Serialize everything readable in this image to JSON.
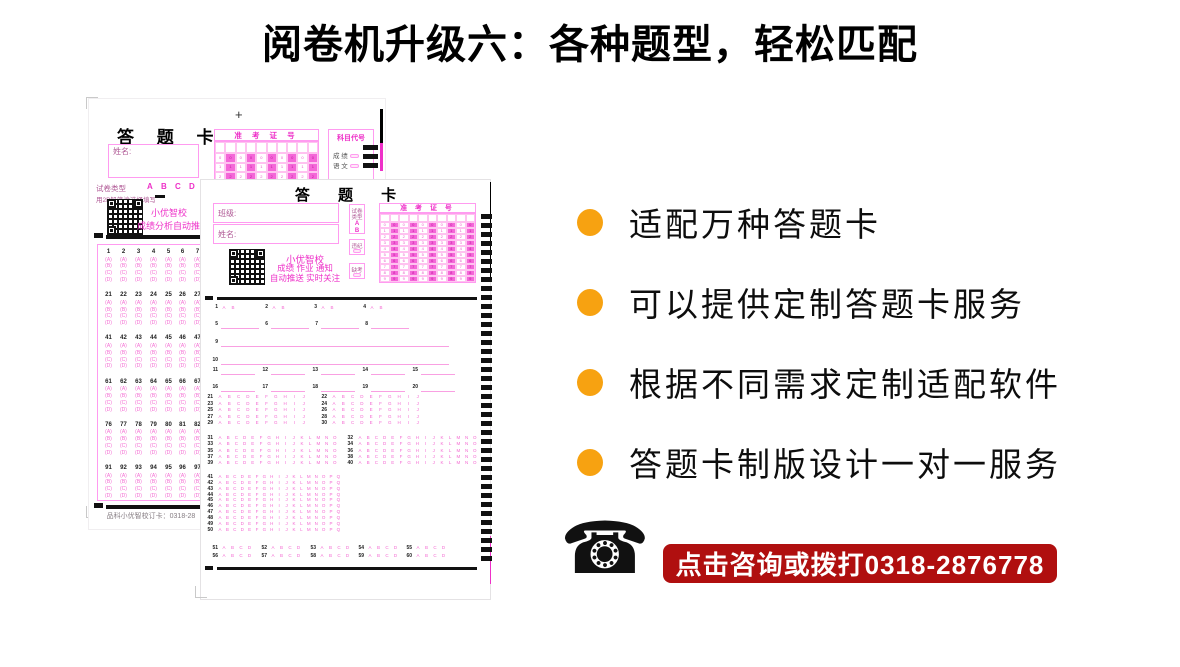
{
  "title": "阅卷机升级六：各种题型，轻松匹配",
  "colors": {
    "accent_orange": "#F7A211",
    "banner_red": "#B00F0F",
    "magenta_strong": "#EE30C8",
    "magenta_letter": "#F46AD2",
    "pink_border": "#FF9BF0",
    "pink_line": "#F9A0E2",
    "label_magenta": "#B05A96"
  },
  "bullets": [
    {
      "label": "适配万种答题卡"
    },
    {
      "label": "可以提供定制答题卡服务"
    },
    {
      "label": "根据不同需求定制适配软件"
    },
    {
      "label": "答题卡制版设计一对一服务"
    }
  ],
  "contact": {
    "phone_icon_glyph": "☎",
    "banner_text": "点击咨询或拨打0318-2876778"
  },
  "sheet_back": {
    "title": "答 题 卡",
    "plus_mark": "+",
    "name_label": "姓名:",
    "ticket_header": "准 考 证 号",
    "subject_code_header": "科目代号",
    "subject_rows": [
      "成 绩",
      "语 文"
    ],
    "paper_type_label": "试卷类型",
    "paper_type_options": [
      "A",
      "B",
      "C",
      "D"
    ],
    "pencil_note": "用2B铅笔涂选择填写",
    "qr_caption_lines": [
      "小优智校",
      "成绩分析自动推送"
    ],
    "answer_blocks": [
      {
        "start": 1
      },
      {
        "start": 21
      },
      {
        "start": 41
      },
      {
        "start": 61
      },
      {
        "start": 76
      },
      {
        "start": 91
      }
    ],
    "choices": [
      "A",
      "B",
      "C",
      "D"
    ],
    "footer": "品科小优智校订卡：0318-28"
  },
  "sheet_front": {
    "title": "答 题 卡",
    "class_label": "班级:",
    "name_label": "姓名:",
    "paper_type_label_lines": [
      "试卷",
      "类型"
    ],
    "paper_type_options": [
      "A",
      "B"
    ],
    "violation_label": "违纪",
    "absent_label": "缺考",
    "ticket_header": "准 考 证 号",
    "qr_caption_lines": [
      "小优智校",
      "成绩 作业 通知",
      "自动推送 实时关注"
    ],
    "questions": {
      "true_false": {
        "numbers": [
          1,
          2,
          3,
          4
        ],
        "options": [
          "A",
          "B"
        ]
      },
      "fill_short": [
        5,
        6,
        7,
        8
      ],
      "fill_long": [
        9,
        10
      ],
      "fill_rows": [
        [
          11,
          12,
          13,
          14,
          15
        ],
        [
          16,
          17,
          18,
          19,
          20
        ]
      ],
      "multi_10": {
        "left": [
          21,
          23,
          25,
          27,
          29
        ],
        "right": [
          22,
          24,
          26,
          28,
          30
        ],
        "options": "ABCDEFGHIJ"
      },
      "multi_15": {
        "left": [
          31,
          33,
          35,
          37,
          39
        ],
        "right": [
          32,
          34,
          36,
          38,
          40
        ],
        "options": "ABCDEFGHIJKLMNO"
      },
      "multi_17": {
        "numbers": [
          41,
          42,
          43,
          44,
          45,
          46,
          47,
          48,
          49,
          50
        ],
        "options": "ABCDEFGHIJKLMNOPQ"
      },
      "choice_4": {
        "rows": [
          [
            51,
            52,
            53,
            54,
            55
          ],
          [
            56,
            57,
            58,
            59,
            60
          ]
        ],
        "options": "ABCD"
      }
    }
  }
}
